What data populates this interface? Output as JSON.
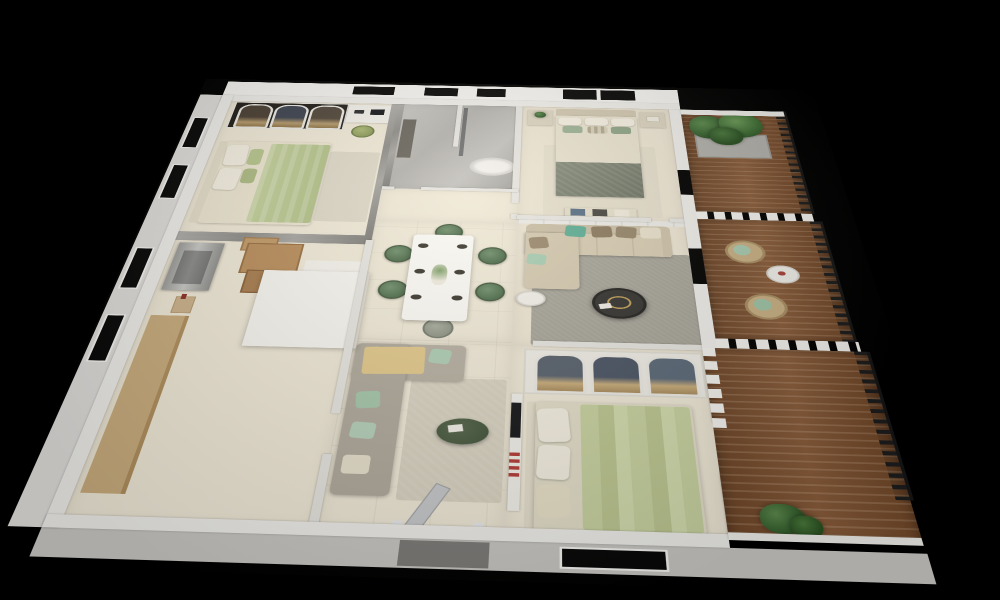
{
  "scene": {
    "type": "3d-apartment-floorplan-render",
    "description": "Isometric photorealistic 3D render of a furnished apartment floor plan viewed from above, on a solid black background",
    "background_color": "#000000",
    "palette": {
      "wall_white": "#efeeea",
      "wall_interior": "#e7e5e0",
      "marble_gray": "#8e8c88",
      "floor_cream": "#f0e9d8",
      "balcony_wood": "#83532f",
      "railing_black": "#1d1d1d",
      "bedding_sage": "#c6d2a0",
      "sofa_beige": "#d8cdb4",
      "sofa_gray": "#b6afa2",
      "accent_teal": "#5fae96",
      "accent_mint": "#aecdb4",
      "dining_chair_green": "#4e6c4c",
      "plant_green": "#35602e",
      "box_cardboard": "#b98e5c",
      "throw_yellow": "#e2c88b"
    },
    "rooms": {
      "bedroom1": {
        "label": "Bedroom with arched wardrobe, desk nook and green bed",
        "furniture": [
          "arched wardrobe with clothes",
          "desk with laptop",
          "olive desk chair",
          "double bed with sage blanket",
          "marble accent walls",
          "rug"
        ]
      },
      "bathroom": {
        "label": "Marble bathroom with oval tub and glass shower",
        "furniture": [
          "oval bathtub",
          "dark vanity",
          "glass shower panel"
        ]
      },
      "corridor": {
        "label": "Hallway",
        "furniture": []
      },
      "dining": {
        "label": "Dining area with set table and six green velvet chairs",
        "furniture": [
          "white dining table",
          "6 place settings",
          "flower centerpiece",
          "5 green chairs",
          "1 gray chair"
        ]
      },
      "lounge": {
        "label": "Entry lounge with gray sofa and green oval coffee table",
        "furniture": [
          "gray L-sofa",
          "yellow throw blanket",
          "mint pillows",
          "beige rug",
          "dark green oval coffee table",
          "open entry door"
        ]
      },
      "kitchen": {
        "label": "Unfitted kitchen / storage room with moving boxes",
        "furniture": [
          "stainless appliance unit",
          "cardboard moving boxes",
          "shopping bag",
          "tan counter",
          "white island"
        ]
      },
      "master_bedroom": {
        "label": "Master bedroom with upholstered bed and twin nightstands",
        "furniture": [
          "beige bed with green throw",
          "2 nightstands",
          "foot bench with cushions",
          "rug"
        ]
      },
      "living": {
        "label": "Living room with beige sectional sofa",
        "furniture": [
          "beige sectional sofa",
          "teal and brown pillows",
          "round dark coffee table with gold tray",
          "white side table",
          "gray rug",
          "paneled wainscot wall"
        ]
      },
      "bedroom3": {
        "label": "Second bedroom with glass wardrobe and sage bed",
        "furniture": [
          "arched glass wardrobe with blue clothes",
          "sage green bed",
          "wall shelf with TV",
          "striped flag art"
        ]
      }
    },
    "balconies": {
      "balcony1": {
        "label": "Top balcony with planter of tropical plants",
        "features": [
          "wood plank deck",
          "concrete planter with plants",
          "black metal railing",
          "white slat privacy fence"
        ]
      },
      "balcony2": {
        "label": "Middle balcony with two rattan chairs",
        "features": [
          "wood plank deck",
          "2 rattan chairs with mint cushions",
          "round white side table",
          "black metal railing",
          "white slat privacy fences"
        ]
      },
      "balcony3": {
        "label": "Large lower balcony",
        "features": [
          "wood plank deck",
          "potted plant",
          "black metal railing",
          "white parapet walls"
        ]
      }
    },
    "windows": {
      "north_facade": 4,
      "west_facade": 4,
      "south_facade": 1,
      "style": "black glazing with white frames"
    },
    "visible_text": ""
  }
}
